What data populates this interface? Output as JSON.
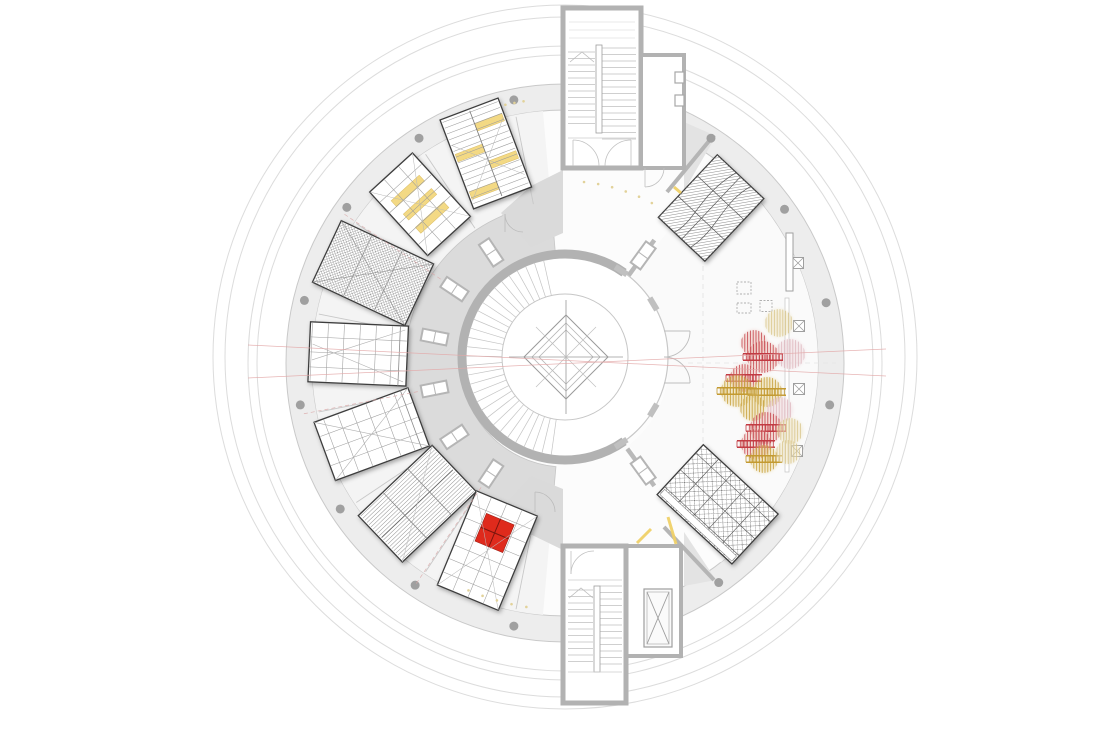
{
  "canvas": {
    "width": 1104,
    "height": 732,
    "background": "#ffffff"
  },
  "palette": {
    "wall_gray": "#b2b2b2",
    "wall_light": "#c9c9c9",
    "band_fill": "#ededed",
    "floor_left": "#f4f4f4",
    "floor_hall": "#fafafa",
    "gallery_ring": "#dbdbdb",
    "line_gray": "#9c9c9c",
    "room_border": "#3e3e3e",
    "column_dot": "#a0a0a0",
    "accent_red": "#df2b1f",
    "accent_yellow": "#f3d77e",
    "section_pink": "#e3a8a8",
    "mark_yellow": "#f0d169",
    "pale_dot": "#e2d29a"
  },
  "plan": {
    "center": {
      "x": 565,
      "y": 363
    },
    "outer_circles": [
      {
        "r": 308
      },
      {
        "r": 317
      },
      {
        "r": 340
      },
      {
        "r": 352
      }
    ],
    "facade_band": {
      "r_inner": 253,
      "r_outer": 279
    },
    "columns": {
      "ring_r": 268,
      "dot_r": 4.5,
      "angles_deg": [
        -57,
        -35,
        -13,
        9,
        55,
        101,
        124,
        147,
        171,
        193.5,
        215.5,
        237,
        259
      ]
    },
    "gallery_ring": {
      "r_inner": 104,
      "r_outer": 160,
      "a1": 95,
      "a2": 265
    },
    "bay_lines_deg": [
      101.25,
      123.75,
      146.25,
      168.75,
      191.25,
      213.75,
      236.25,
      258.75
    ],
    "shaft_angles_deg": [
      -54,
      54,
      123.75,
      146.25,
      168.75,
      191.25,
      213.75,
      236.25
    ],
    "stub_wall_angles_deg": [
      -54,
      54
    ],
    "pink_radial_deg": [
      124,
      169,
      214
    ],
    "section_lines": [
      [
        248,
        345,
        886,
        376
      ],
      [
        248,
        378,
        886,
        349
      ]
    ],
    "dashed_grid": {
      "vx": 703,
      "vy1": 212,
      "vy2": 518,
      "hy": 363,
      "hx1": 688,
      "hx2": 836
    }
  },
  "core": {
    "cx": 565,
    "cy": 357,
    "r_outer": 103,
    "r_inner": 63,
    "wall_w": 9,
    "crescent": {
      "a1": 55,
      "a2": 305
    },
    "treads": {
      "a1": 98,
      "a2": 262,
      "step": 5.5
    },
    "diamond": {
      "cx": 566,
      "cy": 357,
      "sizes": [
        42,
        34,
        27
      ],
      "cross": 57
    },
    "pilaster_angles": [
      -57,
      -31,
      31,
      57
    ]
  },
  "rooms_left": [
    {
      "id": "gallery-1",
      "angle": 249.3,
      "center_r": 224,
      "length": 95,
      "width": 62,
      "pattern": "slats",
      "bars": [
        [
          -38,
          -30,
          -29,
          0
        ],
        [
          -16,
          -8,
          0,
          29
        ],
        [
          2,
          10,
          -29,
          0
        ],
        [
          24,
          32,
          0,
          29
        ]
      ]
    },
    {
      "id": "gallery-2",
      "angle": 227.6,
      "center_r": 215,
      "length": 86,
      "width": 58,
      "pattern": "grid-bars",
      "bars": [
        [
          -22,
          -14,
          -19,
          19
        ],
        [
          -4,
          4,
          -19,
          19
        ],
        [
          14,
          22,
          -19,
          19
        ]
      ]
    },
    {
      "id": "gallery-3",
      "angle": 205.1,
      "center_r": 212,
      "length": 102,
      "width": 68,
      "pattern": "crosshatch"
    },
    {
      "id": "gallery-4",
      "angle": 182.5,
      "center_r": 207,
      "length": 98,
      "width": 60,
      "pattern": "grid-diag"
    },
    {
      "id": "gallery-5",
      "angle": 159.8,
      "center_r": 206,
      "length": 100,
      "width": 62,
      "pattern": "grid-x"
    },
    {
      "id": "gallery-6",
      "angle": 136.4,
      "center_r": 204,
      "length": 102,
      "width": 64,
      "pattern": "stripes"
    },
    {
      "id": "gallery-7",
      "angle": 112.5,
      "center_r": 203,
      "length": 102,
      "width": 66,
      "pattern": "grid-red",
      "red_square": [
        -34,
        -15,
        30,
        30
      ]
    }
  ],
  "rooms_right": [
    {
      "id": "hall-room-1",
      "angle": -46.7,
      "center_r": 213,
      "length": 86,
      "width": 64,
      "pattern": "weave"
    },
    {
      "id": "hall-room-2",
      "angle": 42.8,
      "center_r": 208,
      "length": 102,
      "width": 68,
      "pattern": "lattice"
    }
  ],
  "towers": {
    "top": {
      "x": 563,
      "y": 8,
      "w": 78,
      "h": 160,
      "mid": [
        596,
        45,
        6,
        88
      ],
      "right_room": {
        "x": 641,
        "y": 55,
        "w": 43,
        "h": 113
      }
    },
    "bottom": {
      "x": 563,
      "y": 546,
      "w": 63,
      "h": 157,
      "mid": [
        594,
        586,
        6,
        86
      ],
      "right_room": {
        "x": 626,
        "y": 546,
        "w": 55,
        "h": 110
      },
      "elevator": {
        "x": 644,
        "y": 589,
        "w": 28,
        "h": 58
      }
    }
  },
  "wedges": {
    "top_left": "563,170 563,233 531,247 501,213 531,186",
    "top_right": "684,122 684,191 716,136",
    "bottom_left": "563,550 563,489 531,476 501,509 530,534",
    "bottom_right": "684,532 684,586 716,580",
    "walls": [
      [
        667,
        192,
        714,
        135
      ],
      [
        664,
        527,
        714,
        580
      ]
    ]
  },
  "trees": {
    "colors": {
      "red": {
        "s": "#c23a42",
        "f": "#eec4bc"
      },
      "yellow": {
        "s": "#c39a31",
        "f": "#ead9a0"
      },
      "pink": {
        "s": "#ddb6bd",
        "f": "#f0dade"
      },
      "pale": {
        "s": "#d8c488",
        "f": "#eee4c2"
      }
    },
    "items": [
      {
        "x": 779,
        "y": 323,
        "r": 14,
        "c": "pale",
        "l": false
      },
      {
        "x": 754,
        "y": 343,
        "r": 13,
        "c": "red",
        "l": false
      },
      {
        "x": 790,
        "y": 354,
        "r": 15,
        "c": "pink",
        "l": false
      },
      {
        "x": 763,
        "y": 357,
        "r": 16,
        "c": "red",
        "l": true
      },
      {
        "x": 744,
        "y": 378,
        "r": 14,
        "c": "red",
        "l": true
      },
      {
        "x": 737,
        "y": 391,
        "r": 16,
        "c": "yellow",
        "l": true
      },
      {
        "x": 767,
        "y": 392,
        "r": 15,
        "c": "yellow",
        "l": true
      },
      {
        "x": 753,
        "y": 408,
        "r": 13,
        "c": "yellow",
        "l": false
      },
      {
        "x": 780,
        "y": 410,
        "r": 13,
        "c": "pink",
        "l": false
      },
      {
        "x": 766,
        "y": 428,
        "r": 16,
        "c": "red",
        "l": true
      },
      {
        "x": 790,
        "y": 431,
        "r": 13,
        "c": "pale",
        "l": false
      },
      {
        "x": 756,
        "y": 444,
        "r": 15,
        "c": "red",
        "l": true
      },
      {
        "x": 764,
        "y": 459,
        "r": 14,
        "c": "yellow",
        "l": true
      },
      {
        "x": 788,
        "y": 452,
        "r": 12,
        "c": "pale",
        "l": false
      }
    ]
  },
  "furniture": {
    "x_tables": [
      {
        "x": 798,
        "y": 263
      },
      {
        "x": 799,
        "y": 326
      },
      {
        "x": 799,
        "y": 389
      },
      {
        "x": 797,
        "y": 451
      }
    ],
    "x_table_size": 11,
    "dashed_tables": [
      {
        "x": 744,
        "y": 288,
        "w": 14,
        "h": 12
      },
      {
        "x": 744,
        "y": 308,
        "w": 14,
        "h": 10
      },
      {
        "x": 766,
        "y": 306,
        "w": 12,
        "h": 11
      }
    ],
    "counter": {
      "x": 786,
      "y": 233,
      "w": 7,
      "h": 58
    },
    "rail": {
      "x": 785,
      "y": 298,
      "w": 4,
      "h": 174
    }
  },
  "annotations": {
    "yellow_wall_marks": [
      [
        637,
        543,
        651,
        529
      ],
      [
        668,
        517,
        676,
        544
      ],
      [
        674,
        187,
        681,
        193
      ]
    ],
    "pale_dot_arcs": [
      {
        "r": 182,
        "a1": -84,
        "a2": -60,
        "step": 4.5
      },
      {
        "r": 247,
        "a1": 99,
        "a2": 114,
        "step": 3.5
      },
      {
        "r": 265,
        "a1": -103,
        "a2": -99,
        "step": 2
      }
    ]
  }
}
